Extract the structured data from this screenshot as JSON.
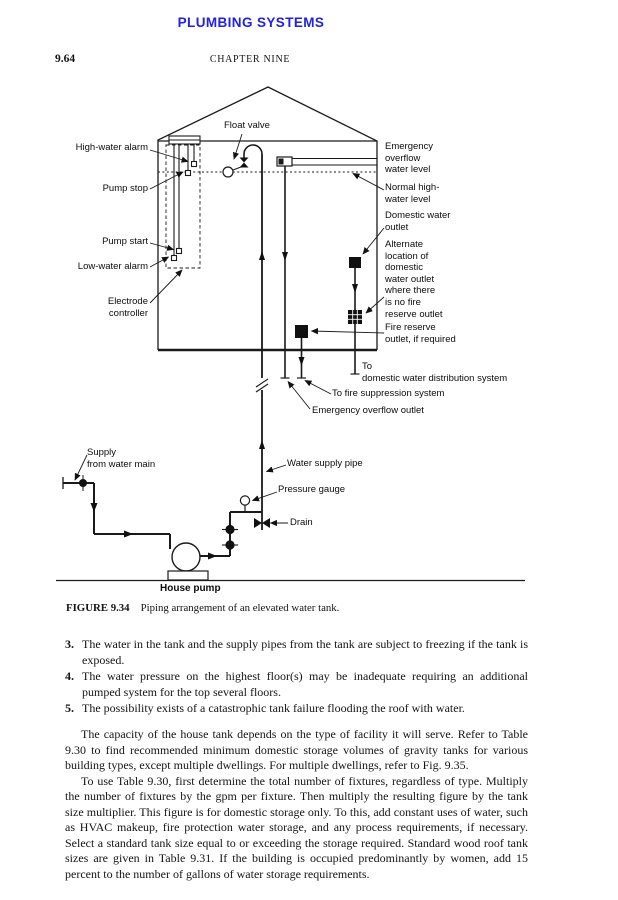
{
  "page": {
    "running_header": "PLUMBING SYSTEMS",
    "page_number": "9.64",
    "chapter_header": "CHAPTER NINE",
    "header_color": "#2121e6"
  },
  "figure": {
    "caption_label": "FIGURE 9.34",
    "caption_text": "Piping arrangement of an elevated water tank.",
    "labels": {
      "float_valve": "Float valve",
      "high_water_alarm": "High-water alarm",
      "pump_stop": "Pump stop",
      "pump_start": "Pump start",
      "low_water_alarm": "Low-water alarm",
      "electrode_controller": "Electrode\ncontroller",
      "emergency_overflow_water_level": "Emergency\noverflow\nwater level",
      "normal_high_water_level": "Normal high-\nwater level",
      "domestic_water_outlet": "Domestic water\noutlet",
      "alternate_location": "Alternate\nlocation of\ndomestic\nwater outlet\nwhere there\nis no fire\nreserve outlet",
      "fire_reserve_outlet": "Fire reserve\noutlet, if required",
      "to_domestic_distribution": "To\ndomestic water distribution system",
      "to_fire_suppression": "To fire suppression system",
      "emergency_overflow_outlet": "Emergency overflow outlet",
      "supply_from_water_main": "Supply\nfrom water main",
      "water_supply_pipe": "Water supply pipe",
      "pressure_gauge": "Pressure gauge",
      "drain": "Drain",
      "house_pump": "House pump"
    }
  },
  "list_items": [
    {
      "number": "3.",
      "text": "The water in the tank and the supply pipes from the tank are subject to freezing if the tank is exposed."
    },
    {
      "number": "4.",
      "text": "The water pressure on the highest floor(s) may be inadequate requiring an additional pumped system for the top several floors."
    },
    {
      "number": "5.",
      "text": "The possibility exists of a catastrophic tank failure flooding the roof with water."
    }
  ],
  "paragraphs": [
    "The capacity of the house tank depends on the type of facility it will serve. Refer to Table 9.30 to find recommended minimum domestic storage volumes of gravity tanks for various building types, except multiple dwellings. For multiple dwellings, refer to Fig. 9.35.",
    "To use Table 9.30, first determine the total number of fixtures, regardless of type. Multiply the number of fixtures by the gpm per fixture. Then multiply the resulting figure by the tank size multiplier. This figure is for domestic storage only. To this, add constant uses of water, such as HVAC makeup, fire protection water storage, and any process requirements, if necessary. Select a standard tank size equal to or exceeding the storage required. Standard wood roof tank sizes are given in Table 9.31. If the building is occupied predominantly by women, add 15 percent to the number of gallons of water storage requirements."
  ]
}
